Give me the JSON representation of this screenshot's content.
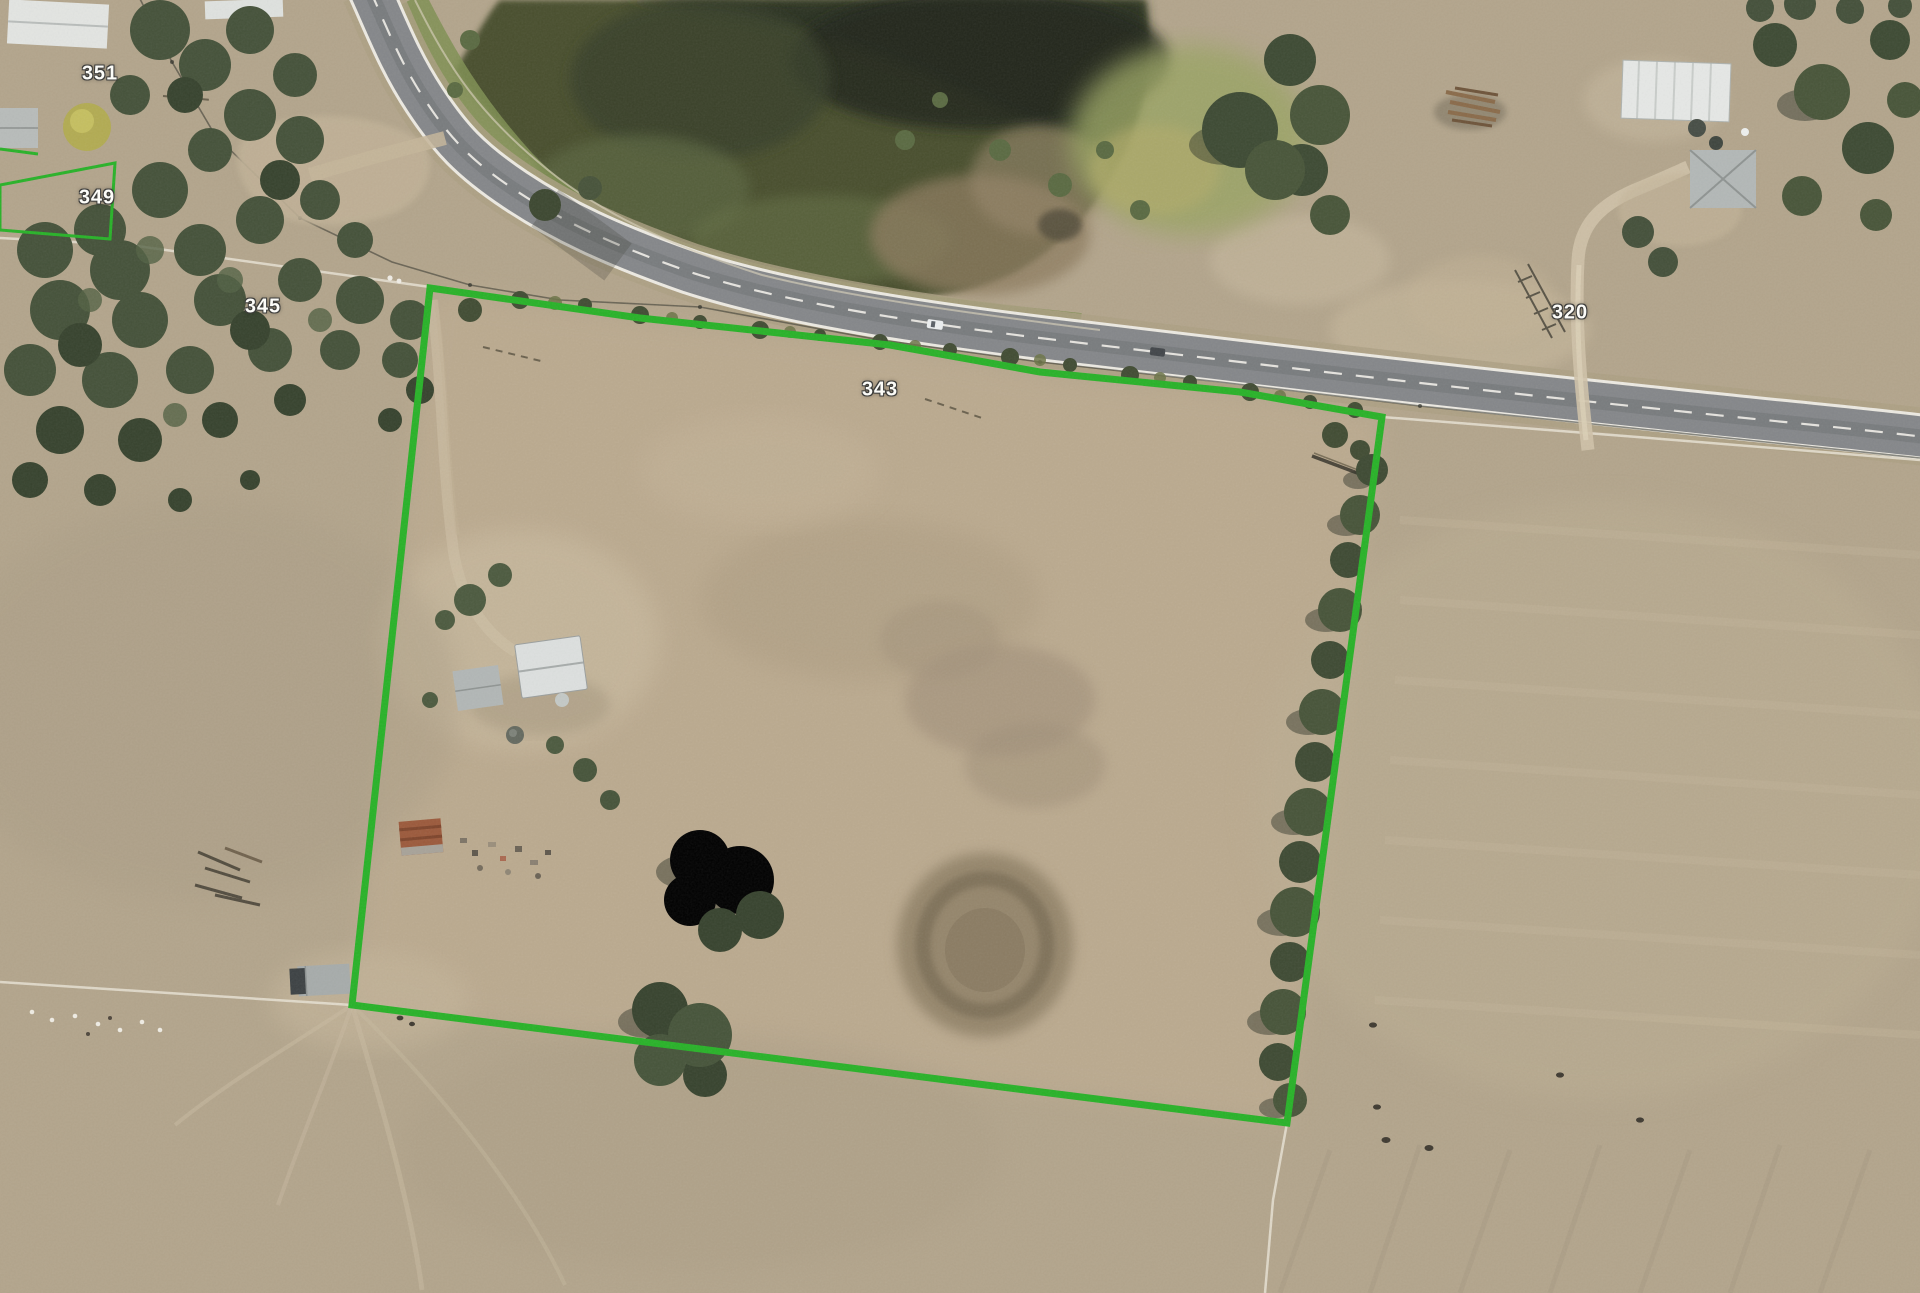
{
  "map": {
    "view": "aerial-imagery",
    "parcel_labels": [
      {
        "text": "351",
        "x": 100,
        "y": 74
      },
      {
        "text": "349",
        "x": 97,
        "y": 198
      },
      {
        "text": "345",
        "x": 263,
        "y": 307
      },
      {
        "text": "343",
        "x": 880,
        "y": 390
      },
      {
        "text": "320",
        "x": 1570,
        "y": 313
      }
    ],
    "highlighted_parcel": {
      "label": "343",
      "boundary_color": "#28b228",
      "boundary_width": "7",
      "points": "430,288 640,318 890,345 1040,372 1240,392 1382,417 1287,1123 352,1005"
    },
    "parcel_349_outline": {
      "boundary_color": "#28b228",
      "boundary_width": "3",
      "points": "0,185 115,163 110,239 0,230"
    },
    "boundary_fragment": {
      "boundary_color": "#28b228",
      "boundary_width": "3",
      "points": "0,149 38,154"
    }
  }
}
